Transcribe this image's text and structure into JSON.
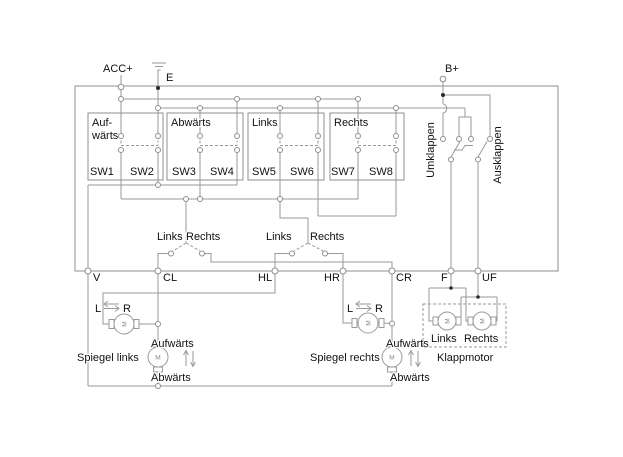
{
  "power": {
    "acc": "ACC+",
    "battery": "B+",
    "ground": "E"
  },
  "boxes": {
    "up_line1": "Auf-",
    "up_line2": "wärts",
    "down": "Abwärts",
    "left": "Links",
    "right": "Rechts"
  },
  "switches": {
    "sw1": "SW1",
    "sw2": "SW2",
    "sw3": "SW3",
    "sw4": "SW4",
    "sw5": "SW5",
    "sw6": "SW6",
    "sw7": "SW7",
    "sw8": "SW8"
  },
  "fold_switches": {
    "fold_in": "Umklappen",
    "fold_out": "Ausklappen"
  },
  "selector_vertical": {
    "left": "Links",
    "right": "Rechts"
  },
  "selector_horizontal": {
    "left": "Links",
    "right": "Rechts"
  },
  "terminals": {
    "v": "V",
    "cl": "CL",
    "hl": "HL",
    "hr": "HR",
    "cr": "CR",
    "f": "F",
    "uf": "UF"
  },
  "mirror_left": {
    "name": "Spiegel links",
    "up": "Aufwärts",
    "down": "Abwärts",
    "l": "L",
    "r": "R"
  },
  "mirror_right": {
    "name": "Spiegel rechts",
    "up": "Aufwärts",
    "down": "Abwärts",
    "l": "L",
    "r": "R"
  },
  "fold_motor": {
    "name": "Klappmotor",
    "left": "Links",
    "right": "Rechts"
  },
  "motor_letter": "M"
}
